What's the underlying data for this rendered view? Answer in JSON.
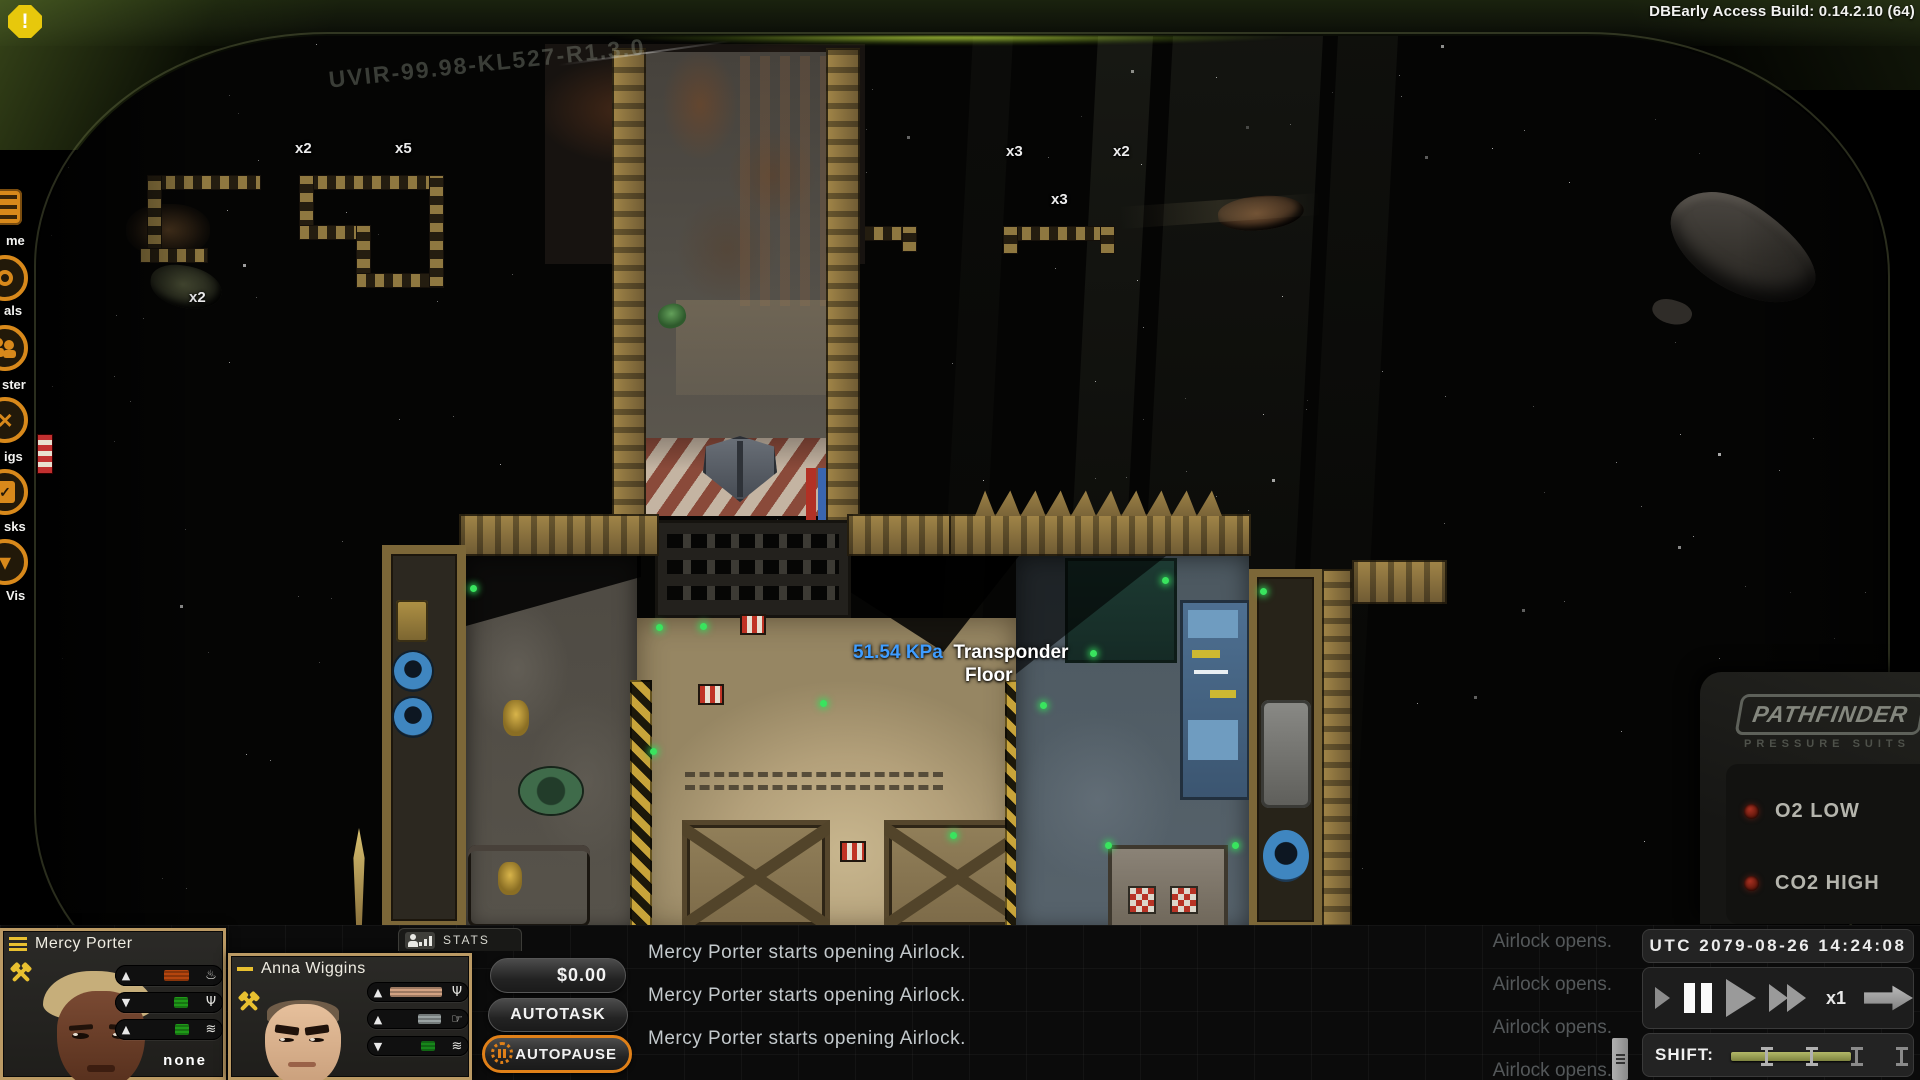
{
  "build": {
    "label": "DBEarly Access Build: 0.14.2.10 (64)"
  },
  "alert": {
    "glyph": "!"
  },
  "sidebar": {
    "items": [
      {
        "id": "game",
        "label": "me"
      },
      {
        "id": "goals",
        "label": "als"
      },
      {
        "id": "roster",
        "label": "ster"
      },
      {
        "id": "ships",
        "label": "igs"
      },
      {
        "id": "tasks",
        "label": "sks"
      },
      {
        "id": "vis",
        "label": "Vis"
      }
    ]
  },
  "scene": {
    "registration": "UVIR-99.98-KL527-R1.3.0",
    "stacks": [
      {
        "text": "x2"
      },
      {
        "text": "x5"
      },
      {
        "text": "x3"
      },
      {
        "text": "x2"
      },
      {
        "text": "x3"
      },
      {
        "text": "x2"
      }
    ],
    "tooltip": {
      "pressure": "51.54 KPa",
      "name": "Transponder",
      "floor": "Floor",
      "pressure_color": "#3f9dff"
    }
  },
  "hud": {
    "brand": "PATHFINDER",
    "sub": "PRESSURE SUITS",
    "led_color": "#6b180c",
    "indicators": [
      {
        "label": "O2 LOW"
      },
      {
        "label": "CO2 HIGH"
      }
    ]
  },
  "crew": [
    {
      "name": "Mercy Porter",
      "task": "none",
      "bars": [
        {
          "dir": "▲",
          "glyph": "♨",
          "color": "#b5450e",
          "left": "44%",
          "width": "40%"
        },
        {
          "dir": "▼",
          "glyph": "Ψ",
          "color": "#1f9a18",
          "left": "60%",
          "width": "22%"
        },
        {
          "dir": "▲",
          "glyph": "≋",
          "color": "#1f9a18",
          "left": "62%",
          "width": "22%"
        }
      ]
    },
    {
      "name": "Anna Wiggins",
      "bars": [
        {
          "dir": "▲",
          "glyph": "Ψ",
          "color": "#d2a282",
          "left": "1%",
          "width": "93%"
        },
        {
          "dir": "▲",
          "glyph": "☞",
          "color": "#9aa3a3",
          "left": "52%",
          "width": "41%"
        },
        {
          "dir": "▼",
          "glyph": "≋",
          "color": "#17871a",
          "left": "58%",
          "width": "24%"
        }
      ]
    }
  ],
  "stats": {
    "label": "STATS"
  },
  "actions": {
    "money": "$0.00",
    "autotask": "AUTOTASK",
    "autopause": "AUTOPAUSE",
    "autopause_accent": "#e08018"
  },
  "log": {
    "left": [
      "Mercy Porter starts opening Airlock.",
      "Mercy Porter starts opening Airlock.",
      "Mercy Porter starts opening Airlock."
    ],
    "right": [
      "Airlock opens.",
      "Airlock opens.",
      "Airlock opens.",
      "Airlock opens."
    ]
  },
  "time": {
    "clock": "UTC 2079-08-26 14:24:08",
    "speed": "x1",
    "shift_label": "SHIFT:"
  }
}
